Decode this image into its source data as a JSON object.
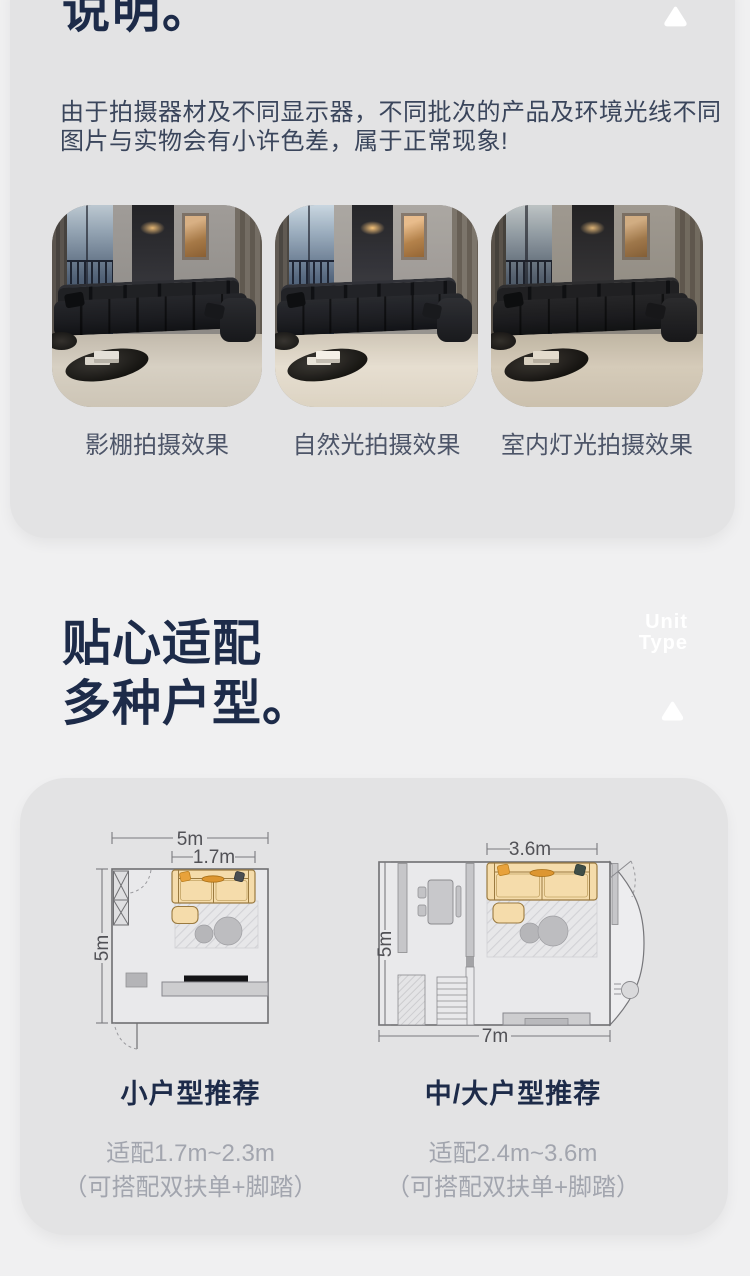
{
  "colors": {
    "page_bg": "#f0f0f1",
    "card_bg": "#e3e3e4",
    "heading": "#1d2b49",
    "body_text": "#3a455b",
    "muted_text": "#a2a5ae",
    "watermark": "#ffffff",
    "sofa_fill": "#f5dcab",
    "pillow_orange": "#e8a23b"
  },
  "notice": {
    "title": "说明。",
    "line1": "由于拍摄器材及不同显示器，不同批次的产品及环境光线不同",
    "line2": "图片与实物会有小许色差，属于正常现象!",
    "photos": [
      {
        "caption": "影棚拍摄效果"
      },
      {
        "caption": "自然光拍摄效果"
      },
      {
        "caption": "室内灯光拍摄效果"
      }
    ]
  },
  "unit": {
    "heading_line1": "贴心适配",
    "heading_line2": "多种户型。",
    "watermark": {
      "line1": "Unit",
      "line2": "Type"
    },
    "plans": [
      {
        "title": "小户型推荐",
        "subtitle": "适配1.7m~2.3m",
        "note": "（可搭配双扶单+脚踏）",
        "dims": {
          "room_width": "5m",
          "sofa_width": "1.7m",
          "room_depth": "5m"
        }
      },
      {
        "title": "中/大户型推荐",
        "subtitle": "适配2.4m~3.6m",
        "note": "（可搭配双扶单+脚踏）",
        "dims": {
          "sofa_width": "3.6m",
          "room_depth": "5m",
          "room_width": "7m"
        }
      }
    ]
  }
}
